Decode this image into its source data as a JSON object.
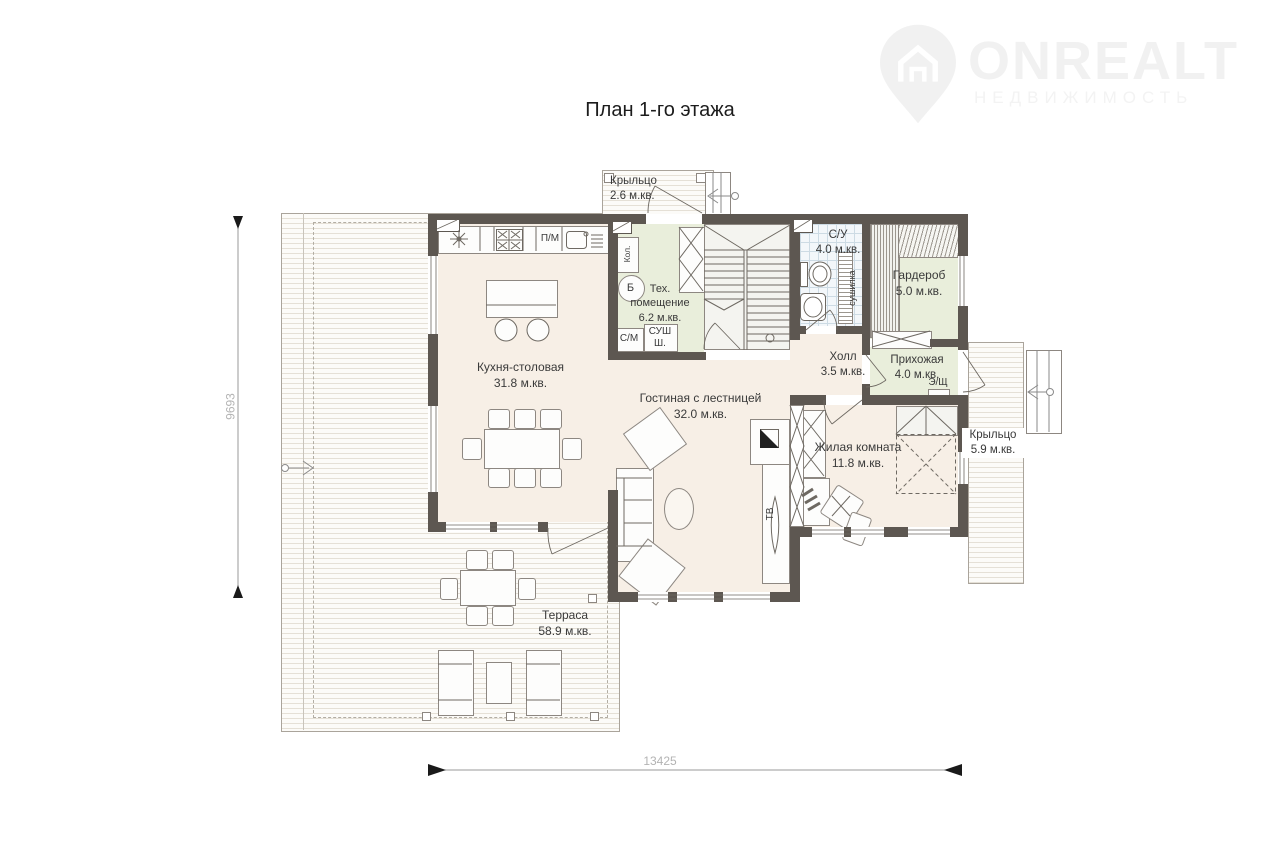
{
  "header": {
    "title": "План 1-го этажа"
  },
  "logo": {
    "brand": "ONREALT",
    "tagline": "НЕДВИЖИМОСТЬ"
  },
  "rooms": {
    "porch_top": {
      "name": "Крыльцо",
      "area": "2.6 м.кв."
    },
    "tech": {
      "name": "Тех. помещение",
      "area": "6.2 м.кв."
    },
    "wc": {
      "name": "С/У",
      "area": "4.0 м.кв."
    },
    "wardrobe": {
      "name": "Гардероб",
      "area": "5.0 м.кв."
    },
    "kitchen": {
      "name": "Кухня-столовая",
      "area": "31.8 м.кв."
    },
    "hall": {
      "name": "Холл",
      "area": "3.5 м.кв."
    },
    "entry": {
      "name": "Прихожая",
      "area": "4.0 м.кв."
    },
    "living": {
      "name": "Гостиная с лестницей",
      "area": "32.0 м.кв."
    },
    "bedroom": {
      "name": "Жилая комната",
      "area": "11.8 м.кв."
    },
    "porch_right": {
      "name": "Крыльцо",
      "area": "5.9 м.кв."
    },
    "terrace": {
      "name": "Терраса",
      "area": "58.9 м.кв."
    }
  },
  "equipment": {
    "dishwasher": "П/М",
    "washing_machine": "С/М",
    "drying_cabinet": "СУШ Ш.",
    "boiler": "Б",
    "water_heater": "Кол.",
    "dryer_rack": "сушилка",
    "tv": "ТВ",
    "electric_panel": "Э/Щ"
  },
  "dimensions": {
    "vertical_mm": "9693",
    "horizontal_mm": "13425"
  },
  "colors": {
    "wall": "#5d5751",
    "room_beige": "#f7efe6",
    "room_green": "#e9eedb",
    "watermark": "#f1f1f1"
  }
}
